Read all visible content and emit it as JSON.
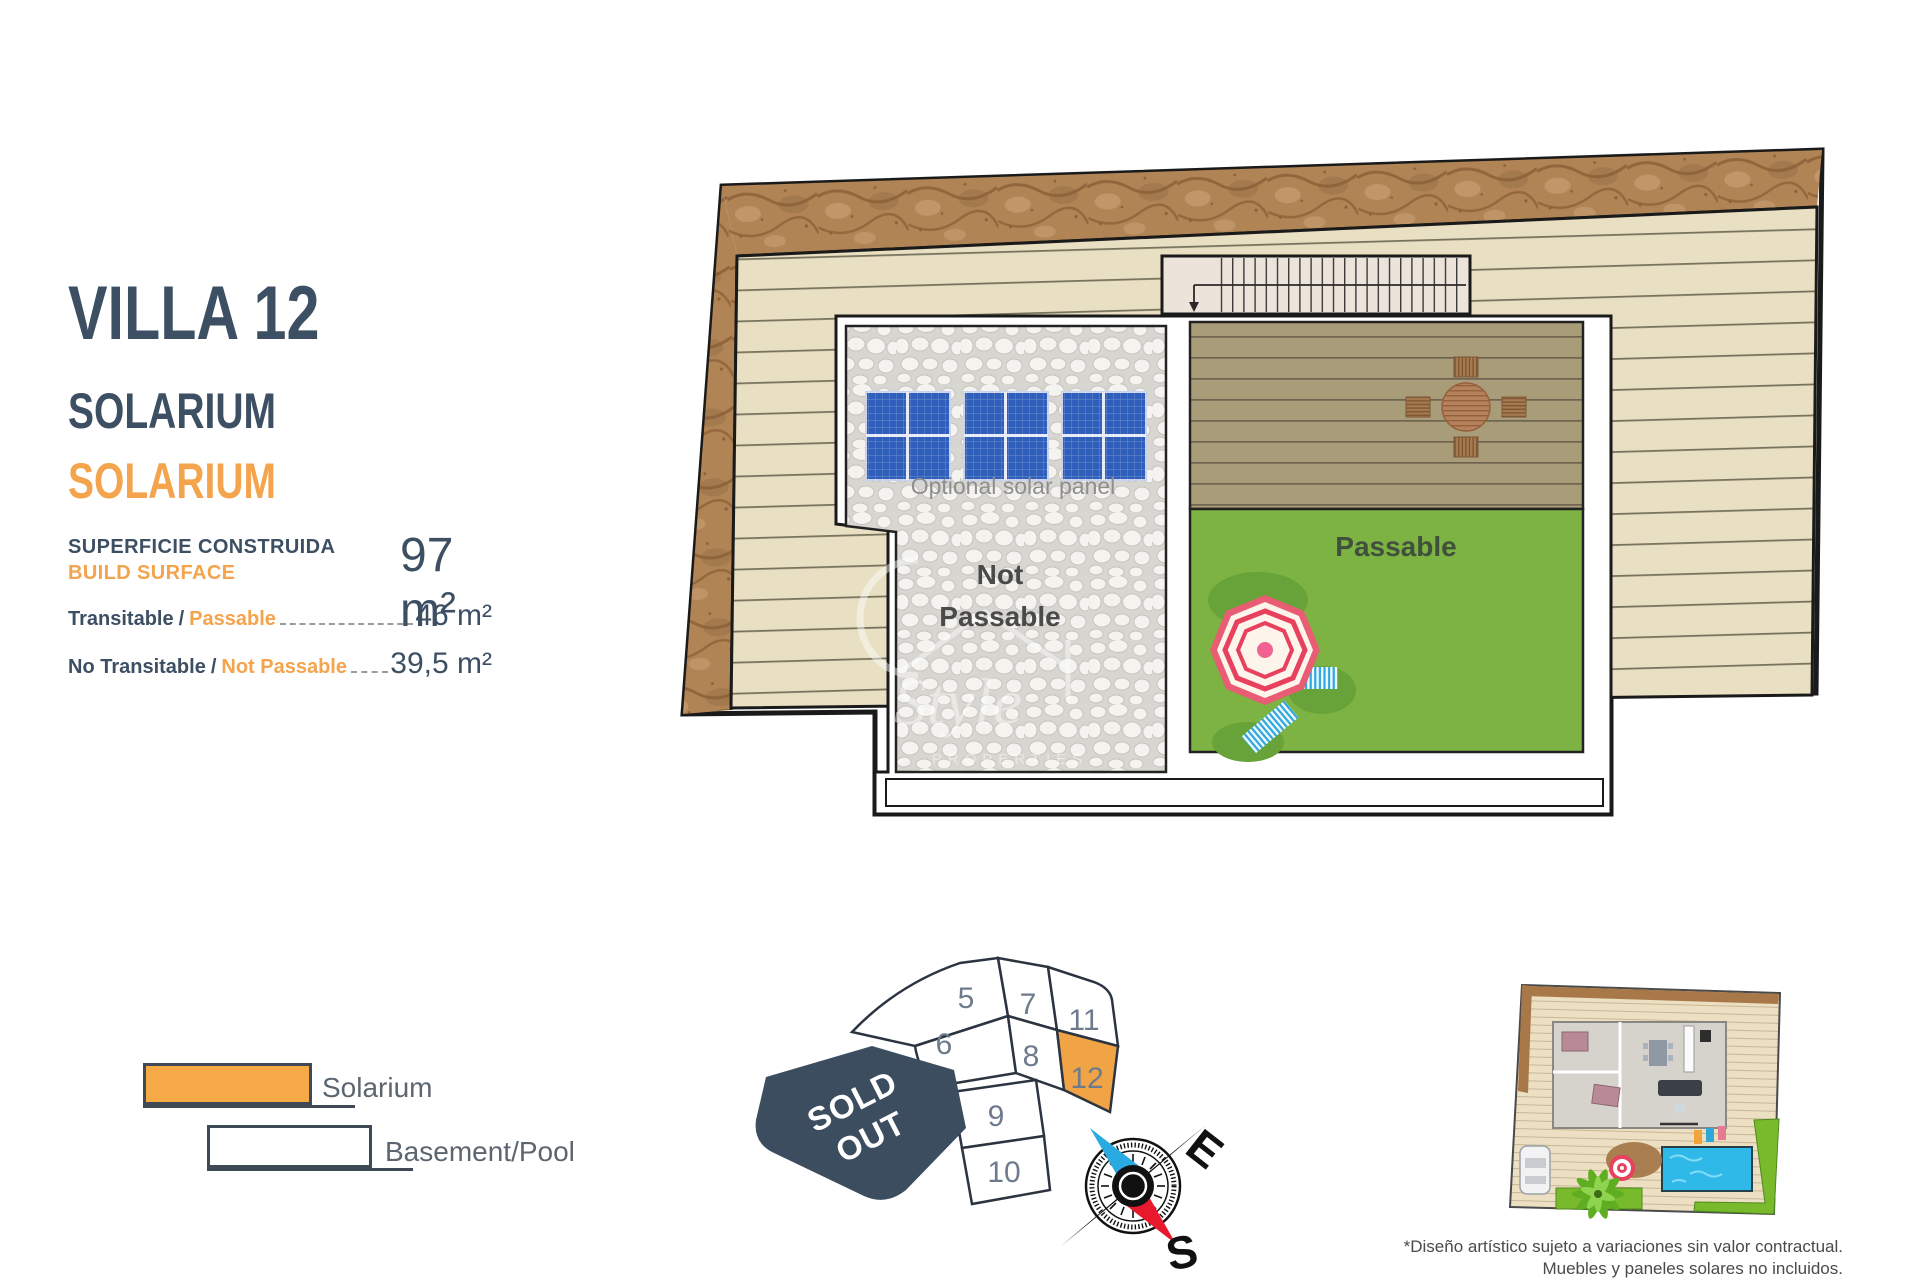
{
  "header": {
    "title": "VILLA 12",
    "subtitle_primary": "SOLARIUM",
    "subtitle_accent": "SOLARIUM"
  },
  "surface": {
    "label_es": "SUPERFICIE CONSTRUIDA",
    "label_en": "BUILD SURFACE",
    "separator": "/",
    "total": "97 m²",
    "rows": [
      {
        "es": "Transitable",
        "en": "Passable",
        "value": "46 m²"
      },
      {
        "es": "No Transitable",
        "en": "Not Passable",
        "value": "39,5 m²"
      }
    ]
  },
  "plan": {
    "labels": {
      "not_passable_line1": "Not",
      "not_passable_line2": "Passable",
      "passable": "Passable",
      "solar": "Optional solar panel"
    },
    "watermark": {
      "script": "Style",
      "sub": "PROPERTIES"
    }
  },
  "legend": {
    "items": [
      {
        "label": "Solarium",
        "swatch": "#f5a947"
      },
      {
        "label": "Basement/Pool",
        "swatch": "#ffffff"
      }
    ]
  },
  "siteplan": {
    "plots": {
      "p5": "5",
      "p6": "6",
      "p7": "7",
      "p8": "8",
      "p9": "9",
      "p10": "10",
      "p11": "11",
      "p12": "12"
    },
    "highlighted_plot": "12",
    "sold_line1": "SOLD",
    "sold_line2": "OUT"
  },
  "compass": {
    "east": "E",
    "south": "S"
  },
  "footer": {
    "disclaimer_line1": "*Diseño artístico sujeto a variaciones sin valor contractual.",
    "disclaimer_line2": "Muebles y paneles solares no incluidos."
  },
  "colors": {
    "accent_orange": "#F3A44C",
    "heading_slate": "#3D4F63",
    "grass_green": "#7CB342",
    "solar_blue": "#2F5FBA",
    "sold_navy": "#3C4D60",
    "deck_wood": "#A99D79",
    "terrace_beige": "#E9E0C3"
  }
}
